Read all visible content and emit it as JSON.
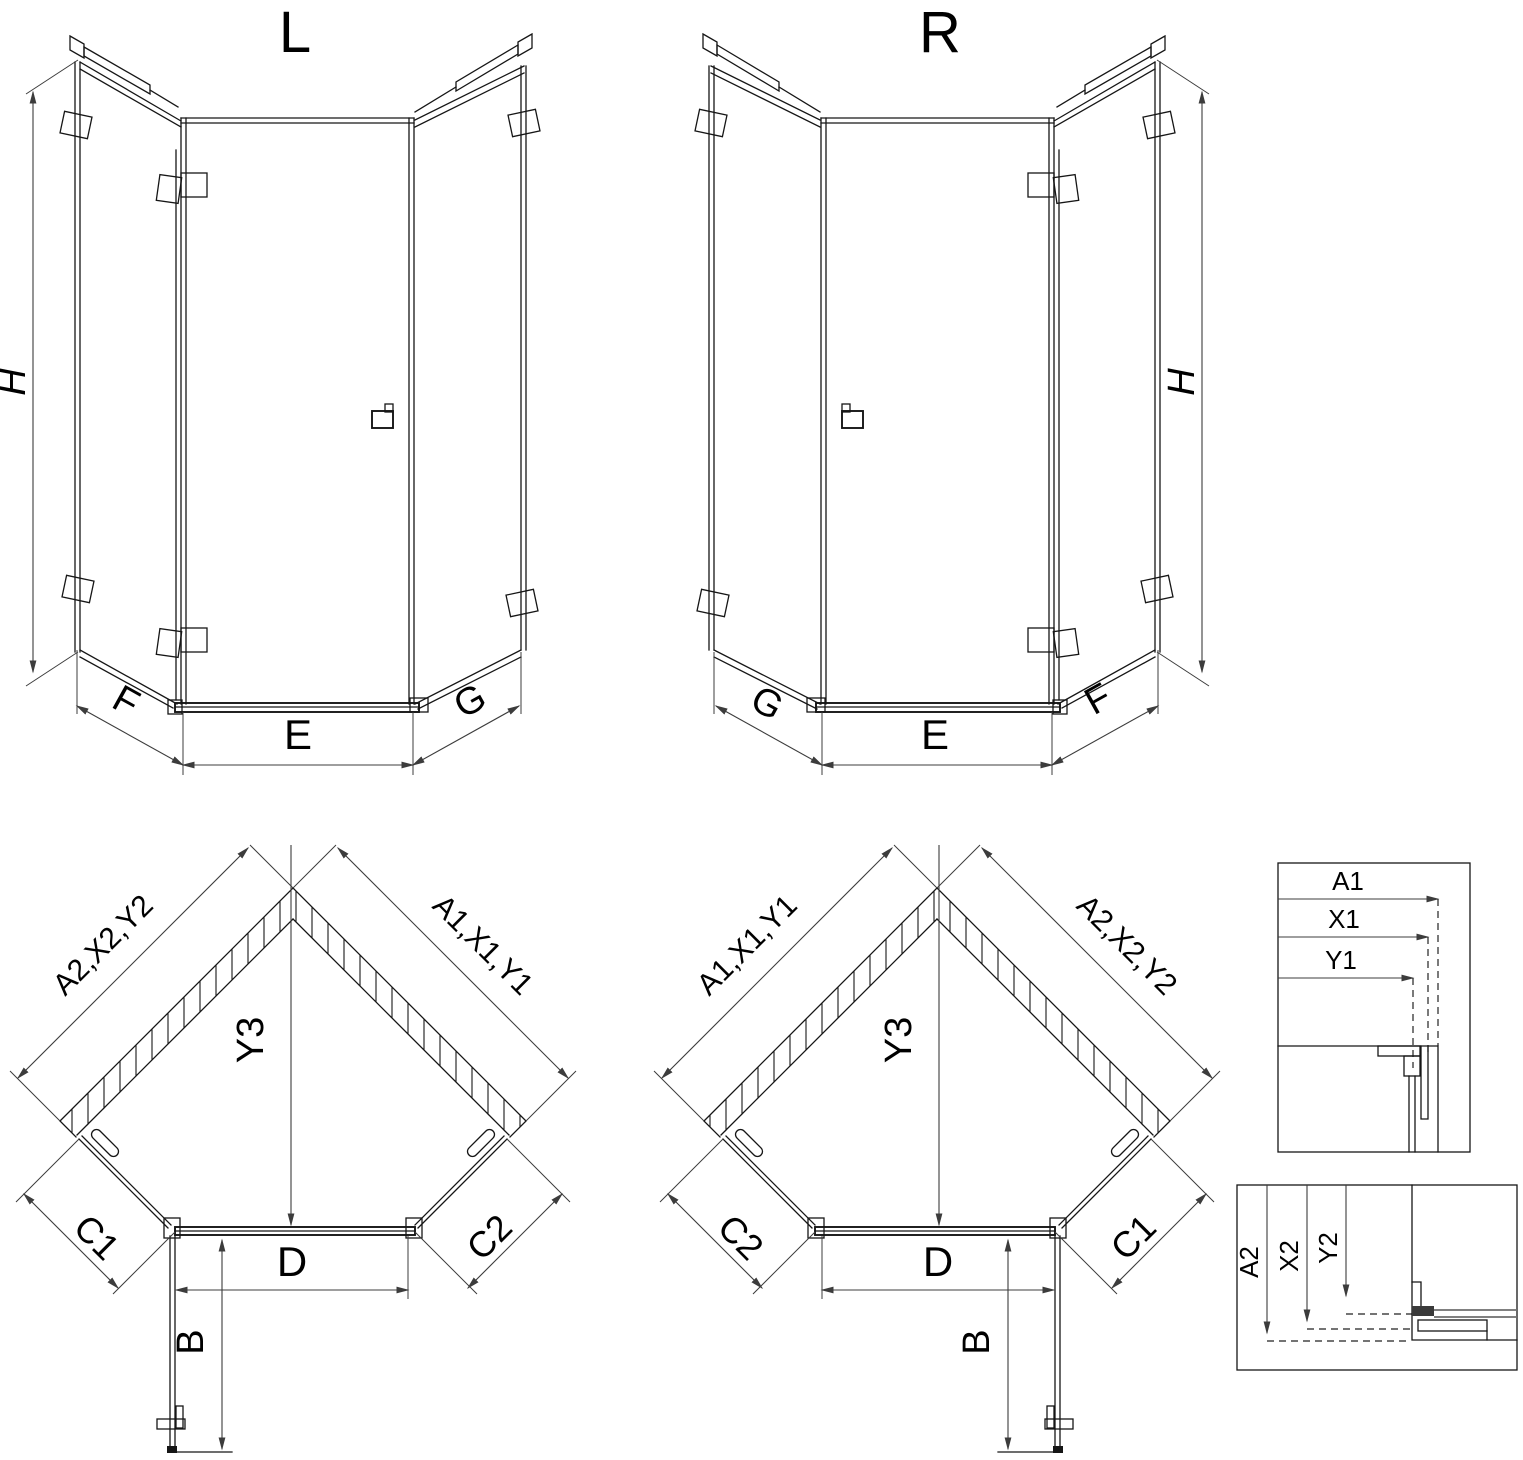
{
  "page": {
    "background": "#ffffff"
  },
  "colors": {
    "line": "#161616",
    "dimension": "#3c3c3c",
    "text": "#000000",
    "profile_gray": "#6e6e6e"
  },
  "iso_left": {
    "title": "L",
    "height_label": "H",
    "left_label": "F",
    "center_label": "E",
    "right_label": "G"
  },
  "iso_right": {
    "title": "R",
    "height_label": "H",
    "left_label": "G",
    "center_label": "E",
    "right_label": "F"
  },
  "plan_left": {
    "left_wall_label": "A2,X2,Y2",
    "right_wall_label": "A1,X1,Y1",
    "diagonal_label": "Y3",
    "left_glass_label": "C1",
    "right_glass_label": "C2",
    "door_width_label": "D",
    "door_swing_label": "B"
  },
  "plan_right": {
    "left_wall_label": "A1,X1,Y1",
    "right_wall_label": "A2,X2,Y2",
    "diagonal_label": "Y3",
    "left_glass_label": "C2",
    "right_glass_label": "C1",
    "door_width_label": "D",
    "door_swing_label": "B"
  },
  "detail_top": {
    "row1": "A1",
    "row2": "X1",
    "row3": "Y1"
  },
  "detail_bottom": {
    "row1": "A2",
    "row2": "X2",
    "row3": "Y2"
  }
}
